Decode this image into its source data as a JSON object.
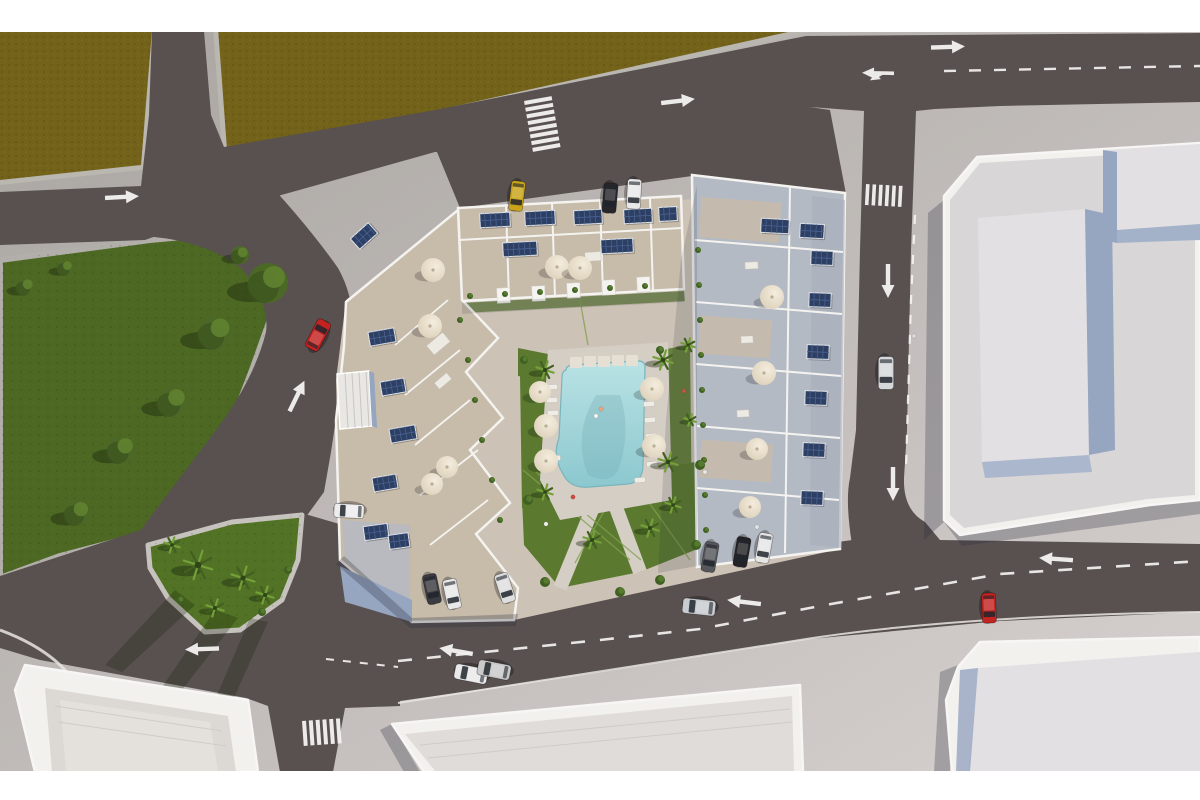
{
  "meta": {
    "type": "aerial-3d-architectural-render",
    "description": "Top-down aerial 3D rendering of a residential apartment complex with rooftop solar panels and terraces around a central courtyard with a turquoise swimming pool, lawns, palm trees and parasols; surrounded by streets with white lane arrows, dashed center lines and zebra crossings, a large green park on the left, dirt lots at top, light commercial buildings on the right and bottom, and parked and driving cars."
  },
  "palette": {
    "page_bg": "#ffffff",
    "base_top": "#a8a4a0",
    "base_bottom": "#d7d1cf",
    "road": "#585150",
    "marking": "#f4f3f1",
    "field": "#73621a",
    "field_edge": "#bab6b0",
    "walk": "#b2aeaa",
    "walk_light": "#c6c2bd",
    "curb": "#e8e5e1",
    "park": "#4c6823",
    "island": "#527226",
    "lawn": "#5b7a30",
    "path_edge": "#7fa04f",
    "tree_mid": "#4c6826",
    "tree_dark": "#3a531e",
    "tree_light": "#618230",
    "palm_dark": "#42601f",
    "palm_light": "#74a038",
    "tree_shadow": "rgba(22,32,10,0.38)",
    "courtyard": "#ccc2b5",
    "deck": "#d5cec5",
    "pool_top": "#b9e2e4",
    "pool_bottom": "#8cc8cf",
    "pool_edge": "#7ab4bc",
    "pool_stone": "#e6dfd3",
    "wall": "#f4f3f0",
    "terrace_tan": "#c7bbaa",
    "terrace_blue": "#b4bac4",
    "solar": "#2d4064",
    "solar_line": "#4d6596",
    "parasol_light": "#f4ecdd",
    "parasol_dark": "#d9cdb5",
    "bldg_wall": "#f2f1ee",
    "parapet": "#f7f6f5",
    "bldg_top": "#d9d6d8",
    "bldg_top2": "#e2e0e3",
    "bldg_face": "#96a5c0",
    "shadow": "rgba(40,44,60,0.28)"
  },
  "scene": {
    "letterbox": {
      "top_height": 32,
      "bottom_y": 771
    },
    "cars": [
      {
        "name": "parked-yellow-car",
        "x": 517,
        "y": 196,
        "a": 97,
        "s": 1,
        "c": "#c9a41a"
      },
      {
        "name": "parked-black-car",
        "x": 610,
        "y": 198,
        "a": 95,
        "s": 1,
        "c": "#27272b"
      },
      {
        "name": "parked-white-car",
        "x": 634,
        "y": 194,
        "a": 93,
        "s": 1,
        "c": "#e9e9e9"
      },
      {
        "name": "driving-silver-car-east-road",
        "x": 886,
        "y": 373,
        "a": 90,
        "s": 1.1,
        "c": "#d5d7da"
      },
      {
        "name": "driving-red-car-west-road",
        "x": 318,
        "y": 335,
        "a": -62,
        "s": 1.05,
        "c": "#c22321"
      },
      {
        "name": "parked-white-car-west",
        "x": 349,
        "y": 511,
        "a": 183,
        "s": 1,
        "c": "#ededed"
      },
      {
        "name": "parked-dark-car-sw",
        "x": 432,
        "y": 589,
        "a": 78,
        "s": 1,
        "c": "#3b3b40"
      },
      {
        "name": "parked-white-car-sw",
        "x": 452,
        "y": 594,
        "a": 78,
        "s": 1,
        "c": "#e8e8e8"
      },
      {
        "name": "parked-white-car-sw2",
        "x": 505,
        "y": 588,
        "a": 72,
        "s": 1,
        "c": "#dedede"
      },
      {
        "name": "driving-white-car-south",
        "x": 471,
        "y": 674,
        "a": 191,
        "s": 1.1,
        "c": "#eaeaea"
      },
      {
        "name": "driving-silver-car-south",
        "x": 494,
        "y": 670,
        "a": 191,
        "s": 1.1,
        "c": "#c9c9c9"
      },
      {
        "name": "driving-silver-car-south2",
        "x": 699,
        "y": 607,
        "a": 186,
        "s": 1.1,
        "c": "#c9ccd0"
      },
      {
        "name": "parked-gray-car-south",
        "x": 710,
        "y": 557,
        "a": 100,
        "s": 1,
        "c": "#56575b"
      },
      {
        "name": "parked-black-car-south",
        "x": 742,
        "y": 552,
        "a": 100,
        "s": 1,
        "c": "#232327"
      },
      {
        "name": "parked-white-car-south",
        "x": 764,
        "y": 548,
        "a": 100,
        "s": 1,
        "c": "#e6e6e6"
      },
      {
        "name": "parked-red-car-southeast",
        "x": 989,
        "y": 608,
        "a": 88,
        "s": 1,
        "c": "#c32421"
      }
    ],
    "arrows": [
      {
        "x": 122,
        "y": 197,
        "a": -3,
        "type": "straight"
      },
      {
        "x": 678,
        "y": 101,
        "a": -7,
        "type": "straight"
      },
      {
        "x": 948,
        "y": 47,
        "a": -2,
        "type": "straight"
      },
      {
        "x": 877,
        "y": 73,
        "a": 181,
        "type": "fork"
      },
      {
        "x": 888,
        "y": 281,
        "a": 90,
        "type": "straight"
      },
      {
        "x": 893,
        "y": 484,
        "a": 90,
        "type": "straight"
      },
      {
        "x": 297,
        "y": 396,
        "a": -64,
        "type": "straight"
      },
      {
        "x": 202,
        "y": 649,
        "a": 178,
        "type": "straight"
      },
      {
        "x": 456,
        "y": 651,
        "a": 190,
        "type": "straight"
      },
      {
        "x": 744,
        "y": 602,
        "a": 187,
        "type": "straight"
      },
      {
        "x": 1056,
        "y": 559,
        "a": 184,
        "type": "straight"
      }
    ],
    "dashed_lines": [
      {
        "pts": [
          [
            944,
            71
          ],
          [
            1200,
            66
          ]
        ],
        "dash": "12 13",
        "w": 2.4
      },
      {
        "pts": [
          [
            915,
            215
          ],
          [
            911,
            300
          ],
          [
            908,
            400
          ],
          [
            906,
            468
          ]
        ],
        "dash": "9 11",
        "w": 2.2
      },
      {
        "pts": [
          [
            398,
            661
          ],
          [
            600,
            640
          ],
          [
            700,
            629
          ],
          [
            820,
            606
          ],
          [
            1000,
            574
          ],
          [
            1200,
            561
          ]
        ],
        "dash": "14 15",
        "w": 2.6
      },
      {
        "pts": [
          [
            326,
            659
          ],
          [
            398,
            667
          ]
        ],
        "dash": "8 9",
        "w": 2
      }
    ],
    "crosswalks": [
      {
        "x": 524,
        "y": 101,
        "a": -10,
        "n": 8,
        "len": 28,
        "sw": 4,
        "gap": 2.8,
        "dir": "h"
      },
      {
        "x": 866,
        "y": 184,
        "a": 3,
        "n": 6,
        "len": 21,
        "sw": 3.6,
        "gap": 3,
        "dir": "v"
      },
      {
        "x": 302,
        "y": 721,
        "a": -4,
        "n": 6,
        "len": 25,
        "sw": 4,
        "gap": 2.8,
        "dir": "v"
      }
    ],
    "trees": [
      {
        "x": 268,
        "y": 283,
        "r": 20
      },
      {
        "x": 215,
        "y": 333,
        "r": 17
      },
      {
        "x": 172,
        "y": 402,
        "r": 15
      },
      {
        "x": 121,
        "y": 450,
        "r": 14
      },
      {
        "x": 77,
        "y": 513,
        "r": 13
      },
      {
        "x": 65,
        "y": 268,
        "r": 8
      },
      {
        "x": 25,
        "y": 287,
        "r": 9
      },
      {
        "x": 240,
        "y": 255,
        "r": 9
      }
    ],
    "island_palms": [
      {
        "x": 198,
        "y": 565,
        "r": 15
      },
      {
        "x": 243,
        "y": 578,
        "r": 12
      },
      {
        "x": 265,
        "y": 595,
        "r": 9
      },
      {
        "x": 215,
        "y": 608,
        "r": 9
      },
      {
        "x": 172,
        "y": 545,
        "r": 8
      }
    ],
    "courtyard_palms": [
      {
        "x": 545,
        "y": 370,
        "r": 9
      },
      {
        "x": 663,
        "y": 360,
        "r": 10
      },
      {
        "x": 668,
        "y": 462,
        "r": 10
      },
      {
        "x": 545,
        "y": 492,
        "r": 8
      },
      {
        "x": 592,
        "y": 540,
        "r": 9
      },
      {
        "x": 650,
        "y": 528,
        "r": 9
      },
      {
        "x": 673,
        "y": 505,
        "r": 8
      },
      {
        "x": 688,
        "y": 345,
        "r": 7
      },
      {
        "x": 690,
        "y": 420,
        "r": 6
      }
    ],
    "parasols": [
      {
        "x": 433,
        "y": 270,
        "r": 12
      },
      {
        "x": 557,
        "y": 267,
        "r": 12
      },
      {
        "x": 580,
        "y": 268,
        "r": 12
      },
      {
        "x": 430,
        "y": 326,
        "r": 12
      },
      {
        "x": 540,
        "y": 392,
        "r": 11
      },
      {
        "x": 546,
        "y": 426,
        "r": 12
      },
      {
        "x": 546,
        "y": 461,
        "r": 12
      },
      {
        "x": 652,
        "y": 389,
        "r": 12
      },
      {
        "x": 654,
        "y": 446,
        "r": 12
      },
      {
        "x": 447,
        "y": 467,
        "r": 11
      },
      {
        "x": 432,
        "y": 484,
        "r": 11
      },
      {
        "x": 772,
        "y": 297,
        "r": 12
      },
      {
        "x": 764,
        "y": 373,
        "r": 12
      },
      {
        "x": 757,
        "y": 449,
        "r": 11
      },
      {
        "x": 750,
        "y": 507,
        "r": 11
      }
    ],
    "solar_arrays": [
      {
        "x": 495,
        "y": 220,
        "a": -3,
        "w": 30
      },
      {
        "x": 540,
        "y": 218,
        "a": -3,
        "w": 30
      },
      {
        "x": 588,
        "y": 217,
        "a": -3,
        "w": 28
      },
      {
        "x": 638,
        "y": 216,
        "a": -3,
        "w": 28
      },
      {
        "x": 520,
        "y": 249,
        "a": -3,
        "w": 34
      },
      {
        "x": 617,
        "y": 246,
        "a": -3,
        "w": 32
      },
      {
        "x": 775,
        "y": 226,
        "a": 3,
        "w": 28
      },
      {
        "x": 812,
        "y": 231,
        "a": 3,
        "w": 24
      },
      {
        "x": 822,
        "y": 258,
        "a": 2,
        "w": 22
      },
      {
        "x": 820,
        "y": 300,
        "a": 2,
        "w": 22
      },
      {
        "x": 818,
        "y": 352,
        "a": 2,
        "w": 22
      },
      {
        "x": 816,
        "y": 398,
        "a": 2,
        "w": 22
      },
      {
        "x": 814,
        "y": 450,
        "a": 2,
        "w": 22
      },
      {
        "x": 812,
        "y": 498,
        "a": 2,
        "w": 22
      },
      {
        "x": 382,
        "y": 337,
        "a": -10,
        "w": 26
      },
      {
        "x": 393,
        "y": 387,
        "a": -10,
        "w": 24
      },
      {
        "x": 403,
        "y": 434,
        "a": -10,
        "w": 26
      },
      {
        "x": 385,
        "y": 483,
        "a": -10,
        "w": 24
      },
      {
        "x": 364,
        "y": 236,
        "a": -42,
        "w": 24
      },
      {
        "x": 376,
        "y": 532,
        "a": -8,
        "w": 24
      },
      {
        "x": 399,
        "y": 541,
        "a": -8,
        "w": 20
      },
      {
        "x": 668,
        "y": 214,
        "a": -3,
        "w": 18
      }
    ],
    "loungers": [
      {
        "x": 552,
        "y": 387,
        "a": 88
      },
      {
        "x": 552,
        "y": 400,
        "a": 88
      },
      {
        "x": 553,
        "y": 413,
        "a": 88
      },
      {
        "x": 555,
        "y": 458,
        "a": 88
      },
      {
        "x": 649,
        "y": 404,
        "a": 85
      },
      {
        "x": 650,
        "y": 420,
        "a": 85
      },
      {
        "x": 651,
        "y": 436,
        "a": 85
      },
      {
        "x": 652,
        "y": 464,
        "a": 85
      },
      {
        "x": 640,
        "y": 480,
        "a": 85
      }
    ],
    "planters": [
      {
        "x": 698,
        "y": 250,
        "r": 3
      },
      {
        "x": 699,
        "y": 285,
        "r": 3
      },
      {
        "x": 700,
        "y": 320,
        "r": 3
      },
      {
        "x": 701,
        "y": 355,
        "r": 3
      },
      {
        "x": 702,
        "y": 390,
        "r": 3
      },
      {
        "x": 703,
        "y": 425,
        "r": 3
      },
      {
        "x": 704,
        "y": 460,
        "r": 3
      },
      {
        "x": 705,
        "y": 495,
        "r": 3
      },
      {
        "x": 706,
        "y": 530,
        "r": 3
      },
      {
        "x": 470,
        "y": 296,
        "r": 3
      },
      {
        "x": 505,
        "y": 294,
        "r": 3
      },
      {
        "x": 540,
        "y": 292,
        "r": 3
      },
      {
        "x": 575,
        "y": 290,
        "r": 3
      },
      {
        "x": 610,
        "y": 288,
        "r": 3
      },
      {
        "x": 645,
        "y": 286,
        "r": 3
      },
      {
        "x": 460,
        "y": 320,
        "r": 3
      },
      {
        "x": 468,
        "y": 360,
        "r": 3
      },
      {
        "x": 475,
        "y": 400,
        "r": 3
      },
      {
        "x": 482,
        "y": 440,
        "r": 3
      },
      {
        "x": 492,
        "y": 480,
        "r": 3
      },
      {
        "x": 500,
        "y": 520,
        "r": 3
      },
      {
        "x": 528,
        "y": 500,
        "r": 5
      },
      {
        "x": 700,
        "y": 465,
        "r": 5
      },
      {
        "x": 696,
        "y": 545,
        "r": 5
      },
      {
        "x": 545,
        "y": 582,
        "r": 5
      },
      {
        "x": 620,
        "y": 592,
        "r": 5
      },
      {
        "x": 660,
        "y": 580,
        "r": 5
      },
      {
        "x": 180,
        "y": 600,
        "r": 4
      },
      {
        "x": 262,
        "y": 612,
        "r": 4
      },
      {
        "x": 288,
        "y": 570,
        "r": 4
      },
      {
        "x": 524,
        "y": 360,
        "r": 4
      },
      {
        "x": 660,
        "y": 350,
        "r": 4
      }
    ],
    "figures": [
      {
        "x": 601,
        "y": 409,
        "c": "#e8a87f"
      },
      {
        "x": 596,
        "y": 416,
        "c": "#f5f5f5"
      },
      {
        "x": 573,
        "y": 497,
        "c": "#cf4b42"
      },
      {
        "x": 684,
        "y": 391,
        "c": "#c2574e"
      },
      {
        "x": 546,
        "y": 524,
        "c": "#ececec"
      },
      {
        "x": 705,
        "y": 472,
        "c": "#e6e6e6"
      },
      {
        "x": 914,
        "y": 336,
        "c": "#d9d9d9"
      },
      {
        "x": 757,
        "y": 527,
        "c": "#e2e2e2"
      }
    ]
  }
}
